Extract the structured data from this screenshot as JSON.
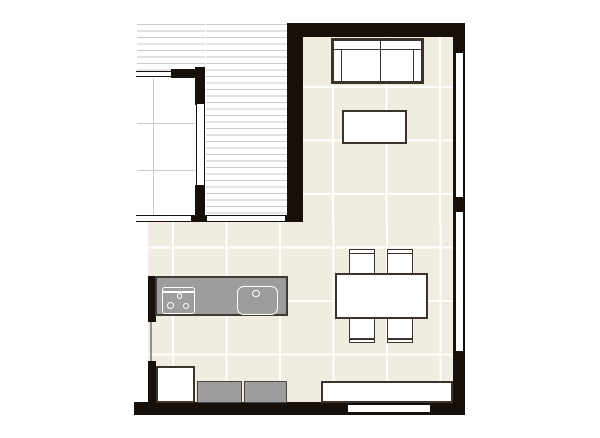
{
  "meta": {
    "kind": "floor_plan",
    "canvas": {
      "width": 600,
      "height": 438
    }
  },
  "colors": {
    "wall": "#17100a",
    "floor_tile": "#f0ecdf",
    "floor_grid": "#ffffff",
    "stripe": "#c9c9c9",
    "tiled_room_grid": "#cccccc",
    "furniture_border": "#3b332b",
    "furniture_gray": "#9d9d9d",
    "furniture_gray_border": "#4a453e",
    "counter_border": "#3e3b36"
  },
  "plan": {
    "grid": {
      "size": 53.5,
      "origin_x": 171.5,
      "origin_y": 86
    },
    "shapes": [
      {
        "name": "main-floor-upper",
        "type": "floor",
        "x": 303,
        "y": 37,
        "w": 150,
        "h": 185
      },
      {
        "name": "main-floor-lower",
        "type": "floor",
        "x": 147.5,
        "y": 222,
        "w": 305.5,
        "h": 180
      },
      {
        "name": "balcony-deck-top",
        "type": "stripes",
        "x": 137,
        "y": 23.5,
        "w": 68,
        "h": 47.5
      },
      {
        "name": "balcony-deck-right",
        "type": "stripes",
        "x": 206,
        "y": 23.5,
        "w": 81,
        "h": 191.5
      },
      {
        "name": "tiled-room-floor",
        "type": "tiled",
        "x": 137,
        "y": 78,
        "w": 58,
        "h": 137
      },
      {
        "name": "tiled-room-grid-vertical",
        "type": "grayline",
        "x": 153,
        "y": 78,
        "w": 1,
        "h": 137
      },
      {
        "name": "tiled-room-grid-horizontal-1",
        "type": "grayline",
        "x": 137,
        "y": 123,
        "w": 58,
        "h": 1
      },
      {
        "name": "tiled-room-grid-horizontal-2",
        "type": "grayline",
        "x": 137,
        "y": 170,
        "w": 58,
        "h": 1
      },
      {
        "name": "wall-top",
        "type": "wall",
        "x": 287,
        "y": 23,
        "w": 178,
        "h": 14
      },
      {
        "name": "wall-left-column",
        "type": "wall",
        "x": 287,
        "y": 23,
        "w": 16,
        "h": 199
      },
      {
        "name": "wall-right",
        "type": "wall",
        "x": 453,
        "y": 23,
        "w": 12,
        "h": 392
      },
      {
        "name": "wall-bottom",
        "type": "wall",
        "x": 134,
        "y": 402,
        "w": 331,
        "h": 13
      },
      {
        "name": "wall-tiled-room-top",
        "type": "wall",
        "x": 171,
        "y": 69,
        "w": 34,
        "h": 9
      },
      {
        "name": "wall-tiled-room-right-upper",
        "type": "wall",
        "x": 195,
        "y": 67,
        "w": 10,
        "h": 38
      },
      {
        "name": "wall-tiled-room-right-lower",
        "type": "wall",
        "x": 195,
        "y": 185,
        "w": 10,
        "h": 37
      },
      {
        "name": "wall-balcony-post",
        "type": "wall",
        "x": 191,
        "y": 215,
        "w": 16,
        "h": 7
      },
      {
        "name": "wall-balcony-end-cap",
        "type": "wall",
        "x": 285,
        "y": 215,
        "w": 18,
        "h": 7
      },
      {
        "name": "wall-kitchen-left-upper",
        "type": "wall",
        "x": 147.5,
        "y": 276,
        "w": 8,
        "h": 46
      },
      {
        "name": "wall-kitchen-left-lower",
        "type": "wall",
        "x": 147.5,
        "y": 361,
        "w": 8,
        "h": 41
      },
      {
        "name": "window-tiled-room-top",
        "type": "window-h",
        "x": 136,
        "y": 71,
        "w": 35,
        "h": 6
      },
      {
        "name": "window-tiled-room-right",
        "type": "window-v",
        "x": 195.5,
        "y": 104,
        "w": 9,
        "h": 81
      },
      {
        "name": "window-balcony-left",
        "type": "window-h",
        "x": 136,
        "y": 215,
        "w": 55,
        "h": 7
      },
      {
        "name": "window-balcony-right",
        "type": "window-h",
        "x": 207,
        "y": 215,
        "w": 78,
        "h": 7
      },
      {
        "name": "window-right-upper",
        "type": "window-v",
        "x": 454.5,
        "y": 53,
        "w": 9.5,
        "h": 144
      },
      {
        "name": "window-right-lower",
        "type": "window-v",
        "x": 454.5,
        "y": 212,
        "w": 9.5,
        "h": 139
      },
      {
        "name": "window-bottom-wall",
        "type": "white-inset",
        "x": 347.5,
        "y": 405,
        "w": 82,
        "h": 7
      },
      {
        "name": "window-kitchen-left",
        "type": "grayline-dark",
        "x": 150,
        "y": 322,
        "w": 1.5,
        "h": 39
      },
      {
        "name": "sofa-frame",
        "type": "furn-white",
        "x": 331,
        "y": 38,
        "w": 93,
        "h": 46
      },
      {
        "name": "sofa-back-cushion-left",
        "type": "furn-white-thin",
        "x": 333,
        "y": 40,
        "w": 48,
        "h": 10
      },
      {
        "name": "sofa-back-cushion-right",
        "type": "furn-white-thin",
        "x": 380,
        "y": 40,
        "w": 41.5,
        "h": 10
      },
      {
        "name": "sofa-armrest-left",
        "type": "furn-white-thin",
        "x": 333,
        "y": 49,
        "w": 9,
        "h": 33
      },
      {
        "name": "sofa-armrest-right",
        "type": "furn-white-thin",
        "x": 412.5,
        "y": 49,
        "w": 9,
        "h": 33
      },
      {
        "name": "sofa-seat-cushion-left",
        "type": "furn-white-thin",
        "x": 341,
        "y": 49,
        "w": 40,
        "h": 33
      },
      {
        "name": "sofa-seat-cushion-right",
        "type": "furn-white-thin",
        "x": 380,
        "y": 49,
        "w": 33.5,
        "h": 33
      },
      {
        "name": "coffee-table",
        "type": "furn-white",
        "x": 342,
        "y": 110,
        "w": 65,
        "h": 34
      },
      {
        "name": "dining-chair-top-left",
        "type": "chair-top",
        "x": 349,
        "y": 249,
        "w": 26,
        "h": 25
      },
      {
        "name": "dining-chair-top-right",
        "type": "chair-top",
        "x": 386.5,
        "y": 249,
        "w": 26.5,
        "h": 25
      },
      {
        "name": "dining-chair-bottom-left",
        "type": "chair-bottom",
        "x": 349,
        "y": 318,
        "w": 26,
        "h": 25
      },
      {
        "name": "dining-chair-bottom-right",
        "type": "chair-bottom",
        "x": 386.5,
        "y": 318,
        "w": 26.5,
        "h": 25
      },
      {
        "name": "dining-table",
        "type": "furn-white",
        "x": 335,
        "y": 273,
        "w": 93,
        "h": 46
      },
      {
        "name": "kitchen-counter",
        "type": "counter",
        "x": 155,
        "y": 276,
        "w": 133,
        "h": 40
      },
      {
        "name": "cooktop",
        "type": "cooktop",
        "x": 162,
        "y": 287,
        "w": 33,
        "h": 27
      },
      {
        "name": "cooktop-burner-small",
        "type": "circle",
        "cx": 179.5,
        "cy": 296,
        "r": 2.6
      },
      {
        "name": "cooktop-burner-left",
        "type": "circle",
        "cx": 170.5,
        "cy": 305.5,
        "r": 3.4
      },
      {
        "name": "cooktop-burner-right",
        "type": "circle",
        "cx": 186,
        "cy": 306,
        "r": 3.4
      },
      {
        "name": "kitchen-sink",
        "type": "sink",
        "x": 237,
        "y": 285.5,
        "w": 40.5,
        "h": 29
      },
      {
        "name": "sink-faucet",
        "type": "circle",
        "cx": 256,
        "cy": 293.5,
        "r": 3.6
      },
      {
        "name": "corner-cabinet-white",
        "type": "furn-white",
        "x": 155.5,
        "y": 366,
        "w": 39.5,
        "h": 37
      },
      {
        "name": "base-unit-gray-1",
        "type": "furn-gray",
        "x": 196.5,
        "y": 380.5,
        "w": 45.5,
        "h": 22.5
      },
      {
        "name": "base-unit-gray-2",
        "type": "furn-gray",
        "x": 243.5,
        "y": 380.5,
        "w": 43.5,
        "h": 22.5
      },
      {
        "name": "low-cabinet-white",
        "type": "furn-white",
        "x": 320.5,
        "y": 380.5,
        "w": 132,
        "h": 22
      }
    ]
  }
}
